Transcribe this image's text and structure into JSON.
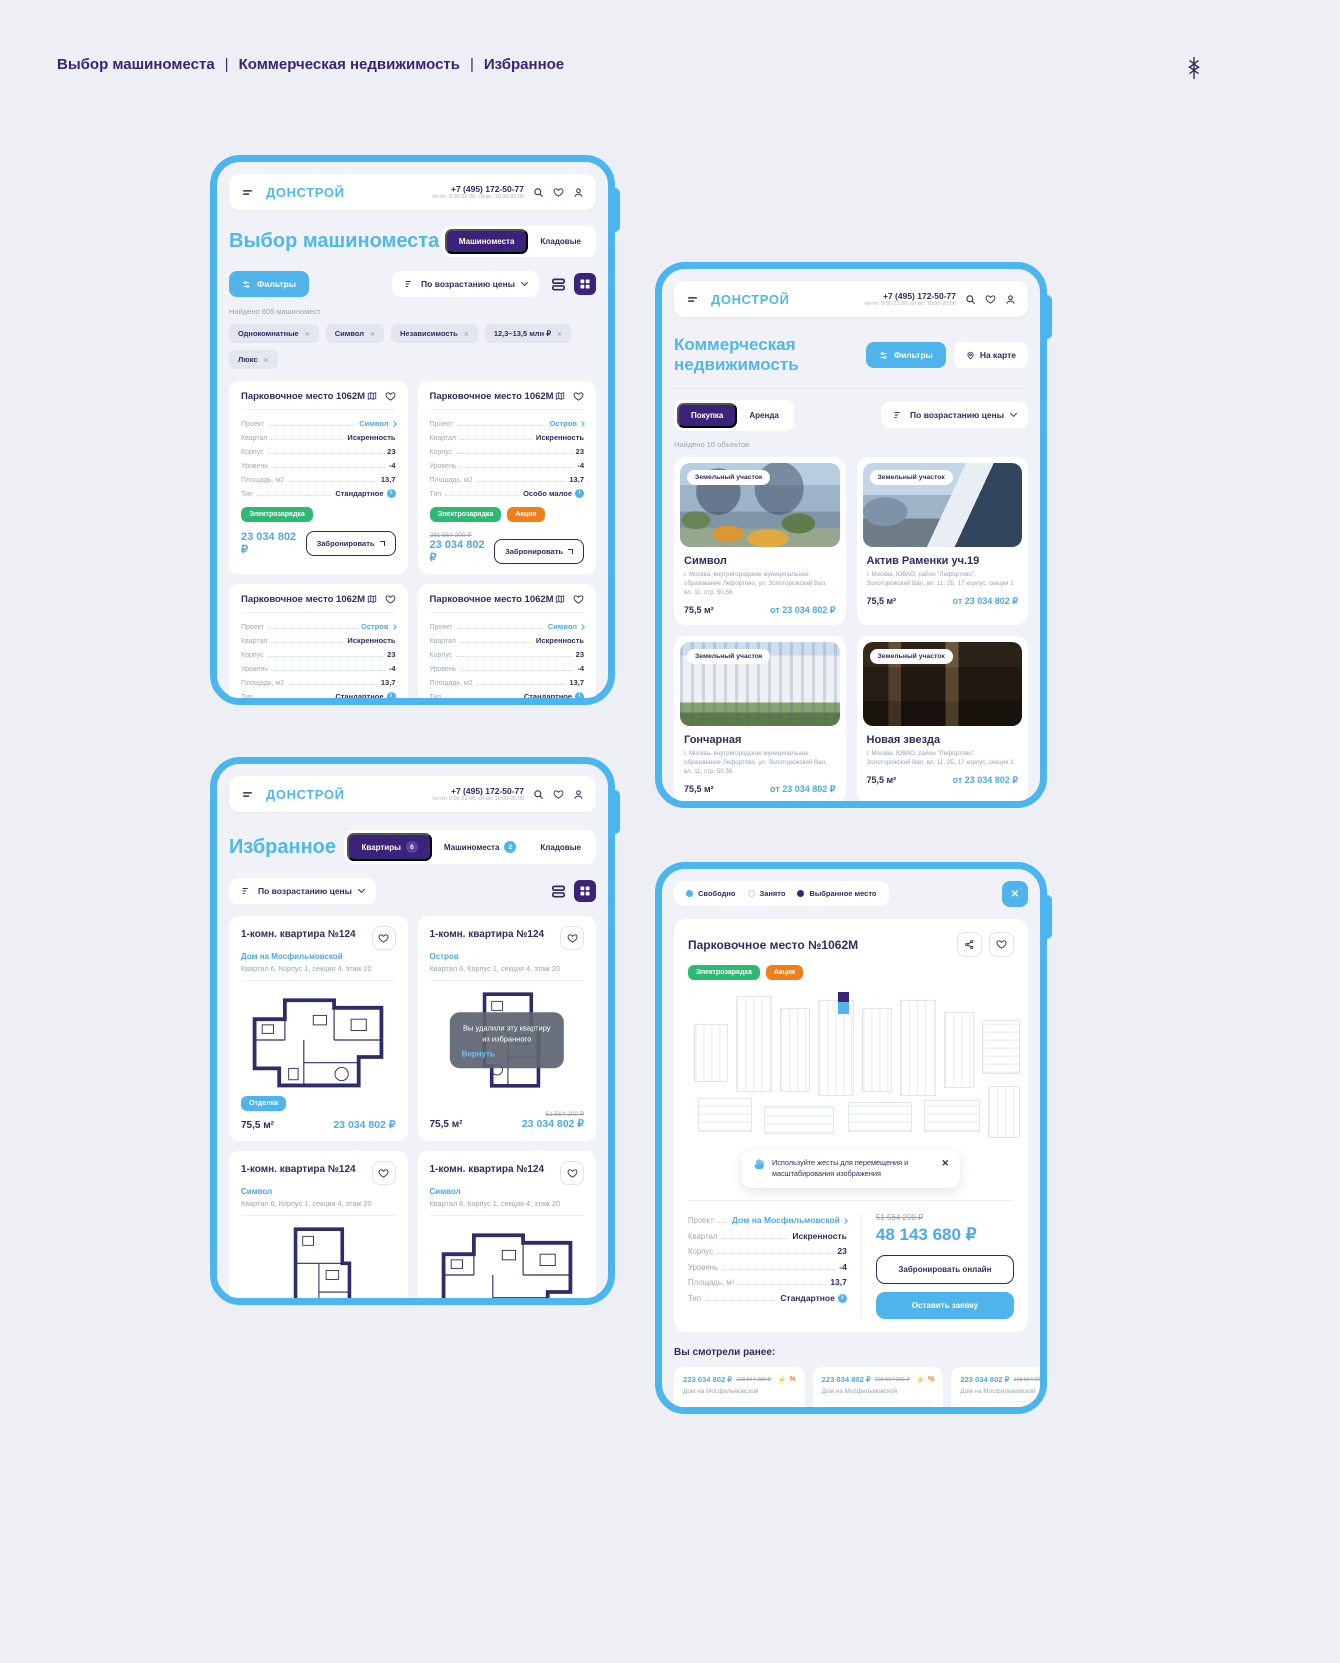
{
  "page": {
    "breadcrumb": [
      "Выбор машиноместа",
      "Коммерческая недвижимость",
      "Избранное"
    ]
  },
  "header": {
    "logo": "ДОНСТРОЙ",
    "phone": "+7 (495) 172-50-77",
    "hours": "пн-пт: 9:00-21:00, сб-вс: 10:00-20:00"
  },
  "parking_list": {
    "title": "Выбор машиноместа",
    "tab_active": "Машиноместа",
    "tab_secondary": "Кладовые",
    "filters": "Фильтры",
    "sort": "По возрастанию цены",
    "found": "Найдено 805 машиномест",
    "chips": [
      "Однокомнатные",
      "Символ",
      "Независимость",
      "12,3–13,5 млн ₽",
      "Люкс"
    ],
    "labels": {
      "project": "Проект",
      "quarter": "Квартал",
      "building": "Корпус",
      "level": "Уровень",
      "area": "Площадь, м2",
      "type": "Тип"
    },
    "book": "Забронировать",
    "cards": [
      {
        "title": "Парковочное место 1062М",
        "project": "Символ",
        "quarter": "Искренность",
        "building": "23",
        "level": "-4",
        "area": "13,7",
        "type": "Стандартное",
        "badge1": "Электрозарядка",
        "price": "23 034 802 ₽"
      },
      {
        "title": "Парковочное место 1062М",
        "project": "Остров",
        "quarter": "Искренность",
        "building": "23",
        "level": "-4",
        "area": "13,7",
        "type": "Особо малое",
        "badge1": "Электрозарядка",
        "badge2": "Акция",
        "old_price": "281 564 200 ₽",
        "price": "23 034 802 ₽"
      },
      {
        "title": "Парковочное место 1062М",
        "project": "Остров",
        "quarter": "Искренность",
        "building": "23",
        "level": "-4",
        "area": "13,7",
        "type": "Стандартное",
        "badge1": "Электрозарядка",
        "badge2": "Акция"
      },
      {
        "title": "Парковочное место 1062М",
        "project": "Символ",
        "quarter": "Искренность",
        "building": "23",
        "level": "-4",
        "area": "13,7",
        "type": "Стандартное",
        "badge1": "Электрозарядка"
      }
    ]
  },
  "commercial": {
    "title": "Коммерческая недвижимость",
    "filters": "Фильтры",
    "map_button": "На карте",
    "tab_active": "Покупка",
    "tab_secondary": "Аренда",
    "sort": "По возрастанию цены",
    "found": "Найдено 10 объектов",
    "cards": [
      {
        "badge": "Земельный участок",
        "title": "Символ",
        "address": "г. Москва, внутригородское муниципальное образование Лефортово, ул. Золоторожский Вал, вл. 11, стр. 50,56",
        "area": "75,5 м²",
        "price": "от 23 034 802 ₽"
      },
      {
        "badge": "Земельный участок",
        "title": "Актив Раменки уч.19",
        "address": "г. Москва, ЮВАО, район \"Лефортово\", Золоторожский Вал, вл. 11, 2Б, 17 корпус, секция 1",
        "area": "75,5 м²",
        "price": "от 23 034 802 ₽"
      },
      {
        "badge": "Земельный участок",
        "title": "Гончарная",
        "address": "г. Москва, внутригородское муниципальное образование Лефортово, ул. Золоторожский Вал, вл. 11, стр. 50,56",
        "area": "75,5 м²",
        "price": "от 23 034 802 ₽"
      },
      {
        "badge": "Земельный участок",
        "title": "Новая звезда",
        "address": "г. Москва, ЮВАО, район \"Лефортово\", Золоторожский Вал, вл. 11, 2Б, 17 корпус, секция 1",
        "area": "75,5 м²",
        "price": "от 23 034 802 ₽"
      }
    ]
  },
  "favorites": {
    "title": "Избранное",
    "tab_apartments": "Квартиры",
    "apartments_count": "6",
    "tab_parking": "Машиноместа",
    "parking_count": "2",
    "tab_storage": "Кладовые",
    "sort": "По возрастанию цены",
    "removed_note": "Вы удалили эту квартиру из избранного",
    "restore": "Вернуть",
    "cards": [
      {
        "title": "1-комн. квартира №124",
        "project": "Дом на Мосфильмовской",
        "location": "Квартал 6, Корпус 1, секция 4, этаж 20",
        "badge": "Отделка",
        "area": "75,5 м²",
        "price": "23 034 802 ₽"
      },
      {
        "title": "1-комн. квартира №124",
        "project": "Остров",
        "location": "Квартал 6, Корпус 1, секция 4, этаж 20",
        "area": "75,5 м²",
        "old_price": "51 564 200 ₽",
        "price": "23 034 802 ₽"
      },
      {
        "title": "1-комн. квартира №124",
        "project": "Символ",
        "location": "Квартал 6, Корпус 1, секция 4, этаж 20"
      },
      {
        "title": "1-комн. квартира №124",
        "project": "Символ",
        "location": "Квартал 6, Корпус 1, секция 4, этаж 20"
      }
    ]
  },
  "parking_detail": {
    "legend_free": "Свободно",
    "legend_occupied": "Занято",
    "legend_selected": "Выбранное место",
    "title": "Парковочное место №1062М",
    "badge1": "Электрозарядка",
    "badge2": "Акция",
    "tooltip": "Используйте жесты для перемещения и масштабирования изображения",
    "labels": {
      "project": "Проект",
      "quarter": "Квартал",
      "building": "Корпус",
      "level": "Уровень",
      "area": "Площадь, м²",
      "type": "Тип"
    },
    "props": {
      "project": "Дом на Мосфильмовской",
      "quarter": "Искренность",
      "building": "23",
      "level": "-4",
      "area": "13,7",
      "type": "Стандартное"
    },
    "old_price": "51 564 200 ₽",
    "price": "48 143 680 ₽",
    "book_online": "Забронировать онлайн",
    "leave_request": "Оставить заявку",
    "history_title": "Вы смотрели ранее:",
    "history": [
      {
        "price": "223 034 802 ₽",
        "old_price": "228 564 200 ₽",
        "project": "Дом на Мосфильмовской",
        "type": "Стандартное",
        "area": "13,7 м²",
        "level": "-6 ур."
      },
      {
        "price": "223 034 802 ₽",
        "old_price": "228 564 200 ₽",
        "project": "Дом на Мосфильмовской",
        "type": "Стандартное",
        "area": "13,7 м²",
        "level": "-6 ур."
      },
      {
        "price": "223 034 802 ₽",
        "old_price": "228 564 200 ₽",
        "project": "Дом на Мосфильмовской",
        "type": "Стандартное",
        "area": "13,7 м²",
        "level": "-6 ур."
      }
    ]
  }
}
